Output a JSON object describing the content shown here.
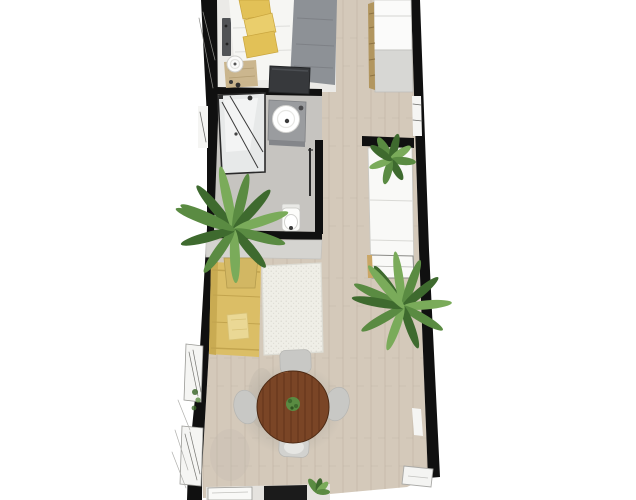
{
  "colors": {
    "background": "#ffffff",
    "wall": "#101010",
    "wood_floor": "#d4c9ba",
    "bedroom_floor": "#ebeae7",
    "bathroom_floor": "#c6c4c0",
    "shower_glass": "#e7e9e9",
    "shower_glass_light": "#f3f4f4",
    "bed_sheet": "#f6f6f3",
    "bed_blanket": "#8d9196",
    "pillow_yellow": "#e2c157",
    "pillow_yellow_light": "#eace6c",
    "nightstand_rug": "#c8b288",
    "lamp_white": "#fbfbfa",
    "side_table_dark": "#515356",
    "tv_unit": "#37393c",
    "closet_white": "#fbfbfa",
    "closet_panel_gray": "#d7d7d4",
    "basket_tan": "#b2965f",
    "vanity_gray": "#9a9c9f",
    "sink_white": "#ffffff",
    "toilet_white": "#fcfcfa",
    "console_gray": "#d5d4d0",
    "counter_white": "#f9f9f7",
    "counter_accent_tan": "#caa665",
    "plant_green": "#5a8b42",
    "plant_green_dark": "#3e6a2e",
    "plant_green_light": "#7aab5a",
    "plant_pot": "#d2b763",
    "sofa_yellow": "#dbbe66",
    "sofa_back": "#c9ab52",
    "sofa_throw": "#ead895",
    "rug_white": "#efeee7",
    "table_wood": "#7a4526",
    "table_wood_dark": "#5c3017",
    "chair_gray": "#c8c8c5",
    "cooktop_black": "#1b1b1b",
    "window_white": "#f5f5f3",
    "shadow_gray": "#8e8e8a"
  },
  "floorplan": {
    "view": "top-down 3d render of a narrow apartment",
    "rooms": [
      {
        "id": "bedroom",
        "position": "top"
      },
      {
        "id": "bathroom",
        "position": "upper-middle-left"
      },
      {
        "id": "hallway",
        "position": "right-side"
      },
      {
        "id": "living-area",
        "position": "middle"
      },
      {
        "id": "dining-area",
        "position": "lower-middle"
      },
      {
        "id": "kitchen",
        "position": "bottom"
      }
    ],
    "furniture": [
      {
        "id": "double-bed",
        "room": "bedroom"
      },
      {
        "id": "pillows",
        "room": "bedroom",
        "count": 3
      },
      {
        "id": "nightstand-lamp",
        "room": "bedroom"
      },
      {
        "id": "side-table",
        "room": "bedroom"
      },
      {
        "id": "tv-unit",
        "room": "bedroom"
      },
      {
        "id": "wardrobe",
        "room": "hallway"
      },
      {
        "id": "storage-baskets",
        "room": "hallway"
      },
      {
        "id": "shower",
        "room": "bathroom"
      },
      {
        "id": "washbasin-vanity",
        "room": "bathroom"
      },
      {
        "id": "toilet",
        "room": "bathroom"
      },
      {
        "id": "sideboard",
        "room": "living-area"
      },
      {
        "id": "potted-palm",
        "room": "living-area",
        "count": 2
      },
      {
        "id": "sofa",
        "room": "living-area"
      },
      {
        "id": "area-rug",
        "room": "living-area"
      },
      {
        "id": "kitchen-counter",
        "room": "hallway"
      },
      {
        "id": "counter-plant",
        "room": "hallway"
      },
      {
        "id": "round-dining-table",
        "room": "dining-area"
      },
      {
        "id": "dining-chairs",
        "room": "dining-area",
        "count": 4
      },
      {
        "id": "cooktop-counter",
        "room": "kitchen"
      },
      {
        "id": "counter-herb-plant",
        "room": "kitchen"
      },
      {
        "id": "windows",
        "room": "living-area"
      },
      {
        "id": "entry-step",
        "room": "kitchen"
      }
    ]
  }
}
